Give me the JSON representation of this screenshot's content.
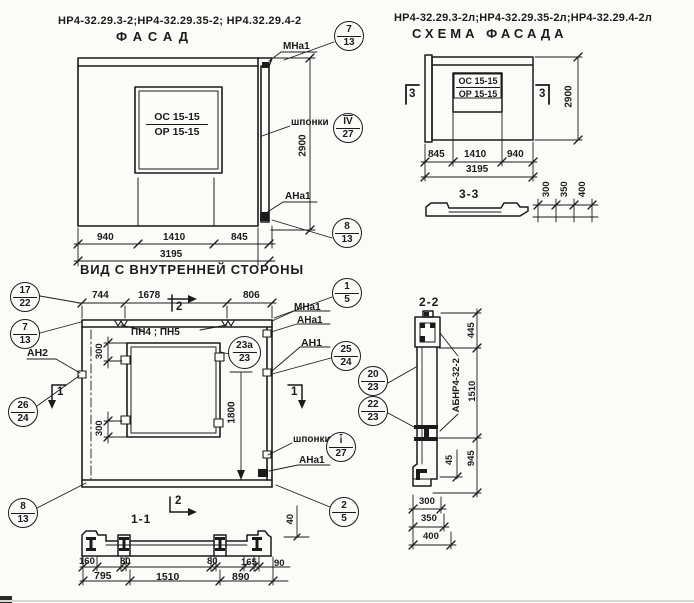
{
  "facade": {
    "title": "НР4-32.29.3-2;НР4-32.29.35-2; НР4.32.29.4-2",
    "heading": "ФАСАД",
    "window_mark_top": "ОС 15-15",
    "window_mark_bot": "ОР 15-15",
    "labels": {
      "mna1": "МНа1",
      "shponki": "шпонки",
      "ana1": "АНа1"
    },
    "dims": {
      "height": "2900",
      "w1": "940",
      "w2": "1410",
      "w3": "845",
      "total": "3195"
    },
    "caption": "ВИД С ВНУТРЕННЕЙ СТОРОНЫ",
    "callouts": {
      "c713": {
        "a": "7",
        "b": "13"
      },
      "key": {
        "a": "IV",
        "b": "27"
      },
      "c813": {
        "a": "8",
        "b": "13"
      }
    }
  },
  "scheme": {
    "title": "НР4-32.29.3-2л;НР4-32.29.35-2л;НР4-32.29.4-2л",
    "heading": "СХЕМА ФАСАДА",
    "window_mark_top": "ОС 15-15",
    "window_mark_bot": "ОР 15-15",
    "section_mark": "3",
    "dims": {
      "height": "2900",
      "w1": "845",
      "w2": "1410",
      "w3": "940",
      "total": "3195"
    }
  },
  "section33": {
    "title": "3-3",
    "dims": [
      "300",
      "350",
      "400"
    ]
  },
  "plan": {
    "dims_top": [
      "744",
      "1678",
      "806"
    ],
    "labels": {
      "pn": "ПН4 ; ПН5",
      "mna1": "МНа1",
      "ana1_top": "АНа1",
      "an2": "АН2",
      "an1": "АН1",
      "shponki": "шпонки",
      "ana1_bot": "АНа1"
    },
    "dims": {
      "d300a": "300",
      "d300b": "300",
      "d1800": "1800",
      "d40": "40"
    },
    "marks": {
      "m1": "1",
      "m2": "2"
    },
    "callouts": {
      "c1722": {
        "a": "17",
        "b": "22"
      },
      "c713": {
        "a": "7",
        "b": "13"
      },
      "c15": {
        "a": "1",
        "b": "5"
      },
      "c2624": {
        "a": "26",
        "b": "24"
      },
      "c23a": {
        "a": "23а",
        "b": "23"
      },
      "c2524": {
        "a": "25",
        "b": "24"
      },
      "key": {
        "a": "i",
        "b": "27"
      },
      "c813": {
        "a": "8",
        "b": "13"
      },
      "c25": {
        "a": "2",
        "b": "5"
      }
    }
  },
  "section11": {
    "title": "1-1",
    "row1": [
      "160",
      "80",
      "80",
      "165",
      "90"
    ],
    "row2": [
      "795",
      "1510",
      "890"
    ]
  },
  "section22": {
    "title": "2-2",
    "beam_label": "АБНР4-32-2",
    "dims": {
      "d445": "445",
      "d1510": "1510",
      "d945": "945",
      "d45": "45",
      "d300": "300",
      "d350": "350",
      "d400": "400"
    },
    "callouts": {
      "c2023": {
        "a": "20",
        "b": "23"
      },
      "c2223": {
        "a": "22",
        "b": "23"
      }
    }
  },
  "colors": {
    "ink": "#1b1b1b",
    "paper": "#fbfbf8"
  }
}
